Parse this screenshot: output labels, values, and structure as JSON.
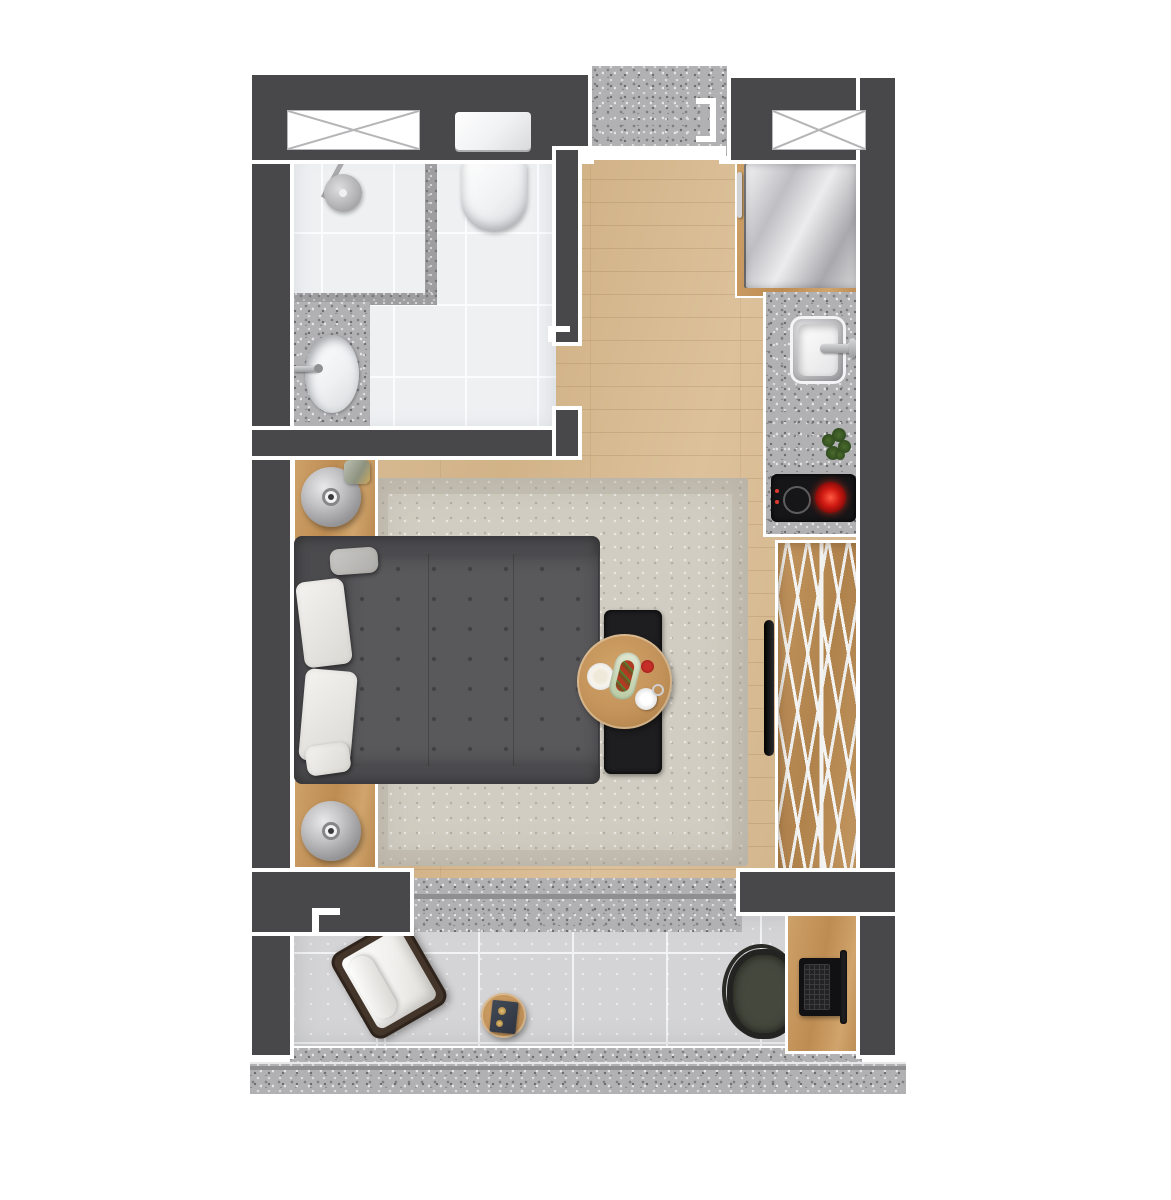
{
  "scene": {
    "type": "floor-plan",
    "view": "top-down",
    "description": "studio-apartment-render",
    "text_labels": []
  },
  "palette": {
    "wall": "#48484a",
    "trim": "#ffffff",
    "wood_floor": "#d6b990",
    "furniture_wood": "#c0925c",
    "granite_counter": "#b1b1b3",
    "bath_tile": "#eef0f2",
    "balcony_tile": "#d4d4d6",
    "rug": "#d1cdc2",
    "bed_upholstery": "#59595c",
    "pillow": "#f4f3f0",
    "appliance_steel": "#c9c9cd",
    "black_furniture": "#1d1d1f",
    "burner_red": "#d01a12",
    "plant_green": "#3c5c26",
    "chair_wicker": "#44352a",
    "desk_chair": "#45483d"
  },
  "rooms": [
    {
      "id": "bathroom",
      "elements": [
        "window",
        "shower-area",
        "shower-head",
        "mosaic-border",
        "toilet",
        "vanity-counter",
        "oval-sink",
        "faucet",
        "door-opening"
      ]
    },
    {
      "id": "entry-hall",
      "elements": [
        "entry-door-opening",
        "corridor-granite-floor",
        "threshold",
        "door-frame-brackets",
        "wood-floor"
      ]
    },
    {
      "id": "kitchen",
      "elements": [
        "window",
        "fridge",
        "granite-counter",
        "kitchen-sink",
        "kitchen-faucet",
        "herb-plant",
        "cooktop",
        "burner-ring",
        "burner-hot"
      ]
    },
    {
      "id": "bedroom-living",
      "elements": [
        "area-rug",
        "double-bed",
        "mattress",
        "pillows",
        "nightstand-top",
        "nightstand-bottom",
        "table-lamp",
        "decor-bottle",
        "bench",
        "round-dining-table",
        "plate",
        "food-tray",
        "red-cup",
        "teacup",
        "tv-panel",
        "open-wardrobe",
        "clothes-hangers"
      ]
    },
    {
      "id": "balcony",
      "elements": [
        "threshold-granite",
        "tile-floor",
        "lounge-chair",
        "lounge-cushion",
        "side-table",
        "book",
        "desk",
        "laptop",
        "desk-chair",
        "outer-granite-band"
      ]
    }
  ]
}
